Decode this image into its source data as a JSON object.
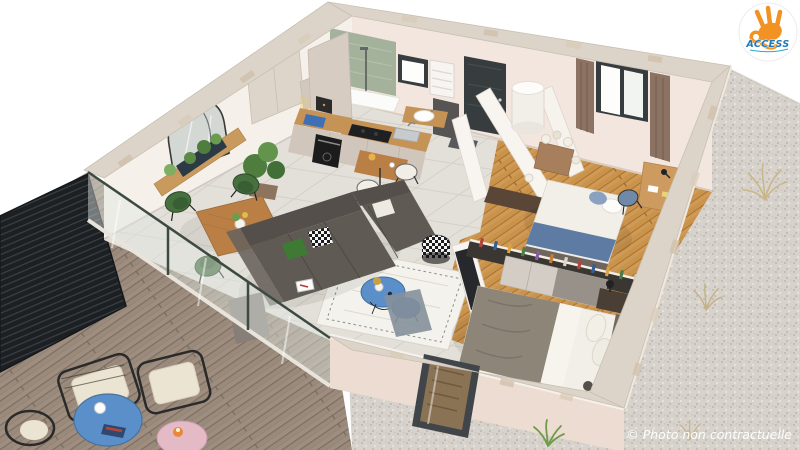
{
  "logo": {
    "brand": "ACCESS"
  },
  "watermark": {
    "text": "© Photo non contractuelle"
  },
  "palette": {
    "background": "#ffffff",
    "wall_top": "#dcd4c8",
    "wall_face": "#f5f0ea",
    "wall_face_pink": "#f3e6de",
    "wall_ext_pink": "#eddcd2",
    "tile_floor": "#e3e0d9",
    "wood_floor": "#cf9a55",
    "deck_wood": "#9a8a7c",
    "gravel_base": "#d7d3cc",
    "railing_dark": "#24272b",
    "sofa_gray": "#5f5a54",
    "chair_green": "#47703f",
    "table_wood": "#b97f45",
    "counter_wood": "#c69356",
    "cabinet_greige": "#d0c6bc",
    "shower_tile": "#a4b29c",
    "door_dark": "#373c3e",
    "door_brown": "#5a4637",
    "curtain_taupe": "#8b7263",
    "accent_blue": "#5b8fc9",
    "bench_blue": "#3b7fc4",
    "table_pink": "#e4bac7",
    "cushion_cream": "#ece4d2",
    "bed_gray": "#8d8578",
    "bed_white": "#f2efe8",
    "headboard_gray": "#6f675e",
    "tv_black": "#27282b",
    "rug_white": "#f4f2ec",
    "plant_green": "#4e7d3e",
    "logo_orange": "#f29222",
    "logo_blue": "#1d78b8",
    "watermark_white": "#ffffff"
  }
}
